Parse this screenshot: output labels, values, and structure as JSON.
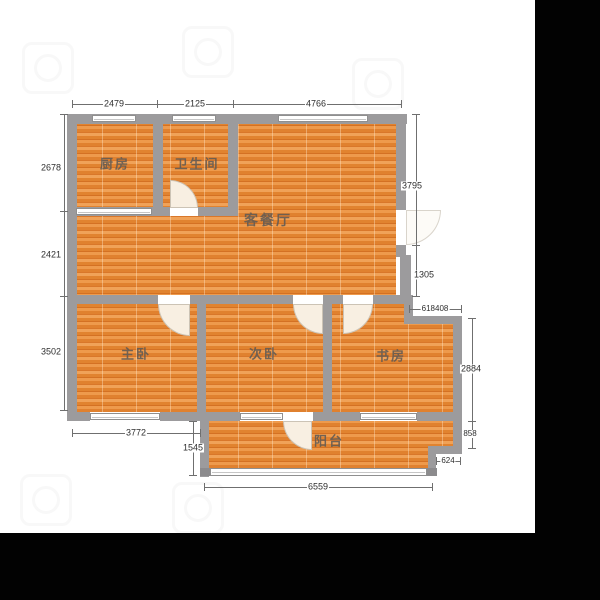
{
  "rooms": {
    "kitchen": "厨房",
    "bathroom": "卫生间",
    "living_dining": "客餐厅",
    "master_bedroom": "主卧",
    "second_bedroom": "次卧",
    "study": "书房",
    "balcony": "阳台"
  },
  "dims": {
    "top_kitchen": "2479",
    "top_bathroom": "2125",
    "top_living": "4766",
    "left_kitchen": "2678",
    "left_living": "2421",
    "left_bedroom": "3502",
    "right_living": "3795",
    "right_door": "1305",
    "study_notch": "618408",
    "right_study": "2884",
    "right_balcony_step": "858",
    "balcony_step_width": "624",
    "bottom_master": "3772",
    "balcony_depth": "1545",
    "bottom_balcony": "6559"
  },
  "colors": {
    "floor_base": "#e2832f",
    "wall": "#9c9b9d",
    "background": "#ffffff",
    "letterbox": "#020202",
    "dimension_text": "#2e2e2e",
    "room_text": "#605a54"
  }
}
